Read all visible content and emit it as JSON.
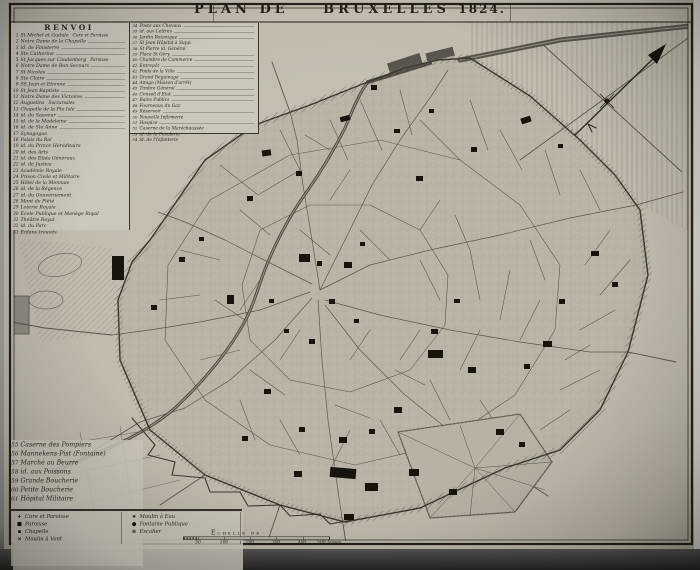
{
  "title": {
    "main": "PLAN DE",
    "city": "BRUXELLES",
    "year": "1824."
  },
  "renvoi": {
    "heading": "RENVOI",
    "col1": [
      {
        "n": "1",
        "label": "St Michel et Gudule",
        "note": "Cure et Paroisse"
      },
      {
        "n": "2",
        "label": "Notre Dame de la Chapelle",
        "leader": true
      },
      {
        "n": "3",
        "label": "id. de Finisterre",
        "leader": true
      },
      {
        "n": "4",
        "label": "Ste Catherine",
        "leader": true
      },
      {
        "n": "5",
        "label": "St Jacques sur Caudenberg",
        "note": "Paroisse"
      },
      {
        "n": "6",
        "label": "Notre Dame de Bon Secours",
        "leader": true
      },
      {
        "n": "7",
        "label": "St Nicolas",
        "leader": true
      },
      {
        "n": "8",
        "label": "Ste Claire",
        "leader": true
      },
      {
        "n": "9",
        "label": "SS Jean et Etienne",
        "leader": true
      },
      {
        "n": "10",
        "label": "St Jean Baptiste",
        "leader": true
      },
      {
        "n": "11",
        "label": "Notre Dame des Victoires",
        "leader": true
      },
      {
        "n": "12",
        "label": "Augustins",
        "note": "Succursales"
      },
      {
        "n": "13",
        "label": "Chapelle de la Pte Isle",
        "leader": true
      },
      {
        "n": "14",
        "label": "id. du Sauveur",
        "leader": true
      },
      {
        "n": "15",
        "label": "id. de la Madeleine",
        "leader": true
      },
      {
        "n": "16",
        "label": "id. de Ste Anne",
        "leader": true
      },
      {
        "n": "17",
        "label": "Synagogue"
      },
      {
        "n": "18",
        "label": "Palais du Roi"
      },
      {
        "n": "19",
        "label": "id. du Prince Héréditaire"
      },
      {
        "n": "20",
        "label": "id. des Arts"
      },
      {
        "n": "21",
        "label": "id. des Etats Généraux"
      },
      {
        "n": "22",
        "label": "id. de Justice"
      },
      {
        "n": "23",
        "label": "Académie Royale"
      },
      {
        "n": "24",
        "label": "Prison Civile et Militaire"
      },
      {
        "n": "25",
        "label": "Hôtel de la Monnaie"
      },
      {
        "n": "26",
        "label": "id. de la Régence"
      },
      {
        "n": "27",
        "label": "id. du Gouvernement"
      },
      {
        "n": "28",
        "label": "Mont de Piété"
      },
      {
        "n": "29",
        "label": "Loterie Royale"
      },
      {
        "n": "30",
        "label": "Ecole Publique et Manège Royal"
      },
      {
        "n": "31",
        "label": "Théâtre Royal"
      },
      {
        "n": "32",
        "label": "id. du Parc"
      },
      {
        "n": "33",
        "label": "Enfans trouvés"
      }
    ],
    "col2": [
      {
        "n": "34",
        "label": "Poste aux Chevaux",
        "leader": true
      },
      {
        "n": "35",
        "label": "id. aux Lettres",
        "leader": true
      },
      {
        "n": "36",
        "label": "Jardin Botanique",
        "leader": true
      },
      {
        "n": "37",
        "label": "St Jean Hôpital à Supp."
      },
      {
        "n": "38",
        "label": "St Pierre id. Général"
      },
      {
        "n": "39",
        "label": "Place St Géry",
        "leader": true
      },
      {
        "n": "40",
        "label": "Chambre de Commerce",
        "leader": true
      },
      {
        "n": "41",
        "label": "Entrepôt",
        "leader": true
      },
      {
        "n": "42",
        "label": "Poids de la Ville",
        "leader": true
      },
      {
        "n": "43",
        "label": "Grand Béguinage",
        "leader": true
      },
      {
        "n": "44",
        "label": "Amigo (Maison d'arrêt)"
      },
      {
        "n": "45",
        "label": "Timbre Général",
        "leader": true
      },
      {
        "n": "46",
        "label": "Conseil d'Etat",
        "leader": true
      },
      {
        "n": "47",
        "label": "Bains Publics",
        "leader": true
      },
      {
        "n": "48",
        "label": "Fourneaux du Gaz"
      },
      {
        "n": "49",
        "label": "Réservoir",
        "leader": true
      },
      {
        "n": "50",
        "label": "Nouvelle Infirmerie"
      },
      {
        "n": "51",
        "label": "Hospice",
        "leader": true
      },
      {
        "n": "52",
        "label": "Caserne de la Maréchaussée"
      },
      {
        "n": "53",
        "label": "id. de la Cavalerie"
      },
      {
        "n": "54",
        "label": "id. de l'Infanterie"
      }
    ],
    "lower": [
      {
        "n": "55",
        "label": "Caserne des Pompiers"
      },
      {
        "n": "56",
        "label": "Mannekens-Pist (Fontaine)"
      },
      {
        "n": "57",
        "label": "Marché au Beurre"
      },
      {
        "n": "58",
        "label": "id. aux Poissons"
      },
      {
        "n": "59",
        "label": "Grande Boucherie"
      },
      {
        "n": "60",
        "label": "Petite Boucherie"
      },
      {
        "n": "61",
        "label": "Hôpital Militaire"
      }
    ]
  },
  "symbols": {
    "left": [
      {
        "glyph": "+",
        "label": "Cure et Paroisse"
      },
      {
        "glyph": "■",
        "label": "Paroisse"
      },
      {
        "glyph": "▪",
        "label": "Chapelle"
      },
      {
        "glyph": "×",
        "label": "Moulin à Vent"
      }
    ],
    "right": [
      {
        "glyph": "∗",
        "label": "Moulin à Eau"
      },
      {
        "glyph": "●",
        "label": "Fontaine Publique"
      },
      {
        "glyph": "≡",
        "label": "Escalier"
      }
    ]
  },
  "scale": {
    "label": "Echelle de",
    "ticks": [
      "50",
      "100",
      "200",
      "300",
      "400",
      "500 Aunes"
    ]
  },
  "colors": {
    "paper": "#c3beb1",
    "ink": "#2e2a22",
    "photo_bg": "#a19f9a"
  }
}
